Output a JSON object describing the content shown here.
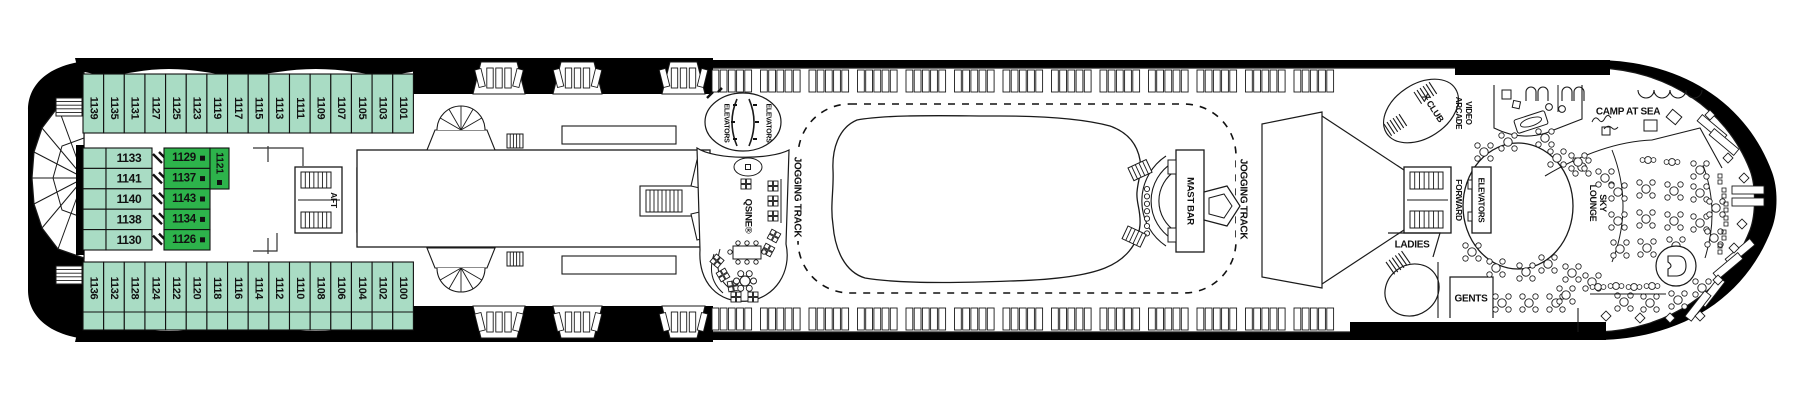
{
  "deck": {
    "cabins": {
      "top_row": [
        "1139",
        "1135",
        "1131",
        "1127",
        "1125",
        "1123",
        "1119",
        "1117",
        "1115",
        "1113",
        "1111",
        "1109",
        "1107",
        "1105",
        "1103",
        "1101"
      ],
      "mid_rows": [
        "1133",
        "1141",
        "1140",
        "1138",
        "1130"
      ],
      "highlighted_rows": [
        "1129",
        "1137",
        "1143",
        "1134",
        "1126"
      ],
      "highlighted_vertical": "1121",
      "bottom_row": [
        "1136",
        "1132",
        "1128",
        "1124",
        "1122",
        "1120",
        "1118",
        "1116",
        "1114",
        "1112",
        "1110",
        "1108",
        "1106",
        "1104",
        "1102",
        "1100"
      ]
    },
    "labels": {
      "aft": "AFT",
      "elevators": "ELEVATORS",
      "qsine": "QSINE®",
      "jogging_track": "JOGGING TRACK",
      "mast_bar": "MAST BAR",
      "x_club": "X CLUB",
      "video_arcade": "VIDEO ARCADE",
      "forward": "FORWARD",
      "ladies": "LADIES",
      "gents": "GENTS",
      "camp_at_sea": "CAMP AT SEA",
      "sky_lounge": "SKY LOUNGE"
    },
    "colors": {
      "cabin_fill": "#a9dcc4",
      "highlight_fill": "#2db34b",
      "hull": "#000000",
      "line": "#1a1a1a"
    }
  }
}
